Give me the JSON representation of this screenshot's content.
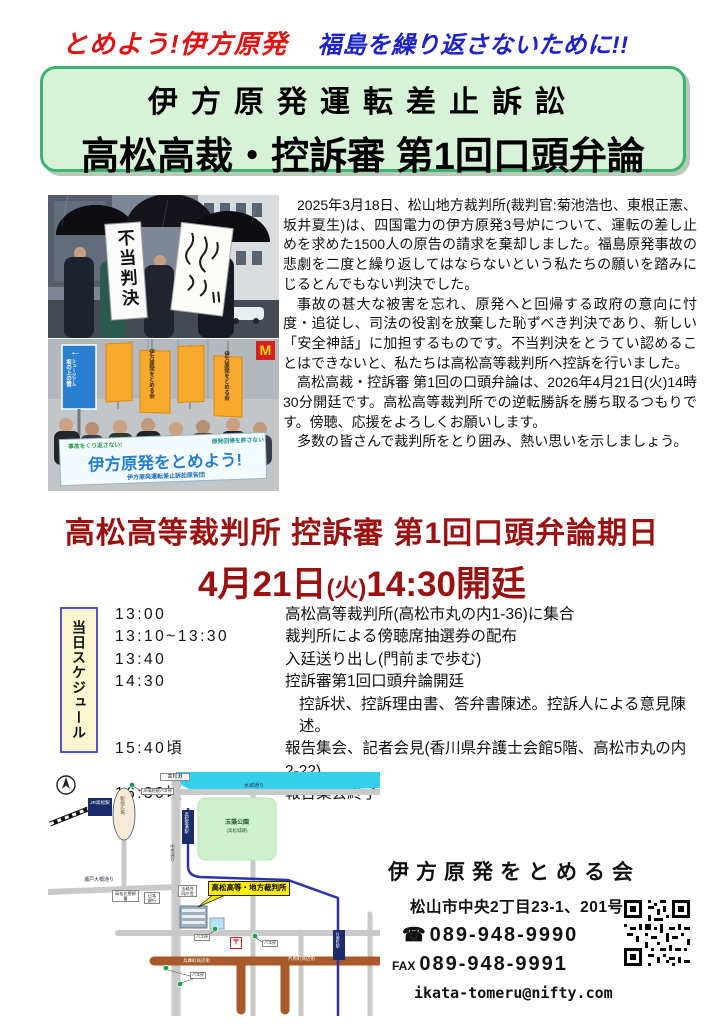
{
  "tagline": {
    "left": "とめよう!伊方原発",
    "right": "福島を繰り返さないために!!"
  },
  "title": {
    "line1": "伊方原発運転差止訴訟",
    "line2": "高松高裁・控訴審 第1回口頭弁論"
  },
  "photos": {
    "top_banner": "不当判決",
    "sign_arrow": "←",
    "sign_line1": "坂の上の雲",
    "sign_line2": "ミュージアム",
    "flag_text": "伊方原発をとめる会",
    "m_sign": "M",
    "banner_small_left": "事故をくり返さない!",
    "banner_small_right": "原発回帰を許さない",
    "banner_main": "伊方原発をとめよう!",
    "banner_sub": "伊方原発運転差止訴訟原告団"
  },
  "body": {
    "p1": "2025年3月18日、松山地方裁判所(裁判官:菊池浩也、東根正憲、坂井夏生)は、四国電力の伊方原発3号炉について、運転の差し止めを求めた1500人の原告の請求を棄却しました。福島原発事故の悲劇を二度と繰り返してはならないという私たちの願いを踏みにじるとんでもない判決でした。",
    "p2": "事故の甚大な被害を忘れ、原発へと回帰する政府の意向に忖度・追従し、司法の役割を放棄した恥ずべき判決であり、新しい「安全神話」に加担するものです。不当判決をとうてい認めることはできないと、私たちは高松高等裁判所へ控訴を行いました。",
    "p3": "高松高裁・控訴審 第1回の口頭弁論は、2026年4月21日(火)14時30分開廷です。高松高等裁判所での逆転勝訴を勝ち取るつもりです。傍聴、応援をよろしくお願いします。",
    "p4": "多数の皆さんで裁判所をとり囲み、熱い思いを示しましょう。"
  },
  "heading": {
    "line1": "高松高等裁判所 控訴審 第1回口頭弁論期日",
    "date": "4月21日",
    "day": "(火)",
    "time": "14:30開廷"
  },
  "schedule": {
    "label": "当日スケジュール",
    "rows": [
      {
        "time": "13:00",
        "desc": "高松高等裁判所(高松市丸の内1-36)に集合"
      },
      {
        "time": "13:10~13:30",
        "desc": "裁判所による傍聴席抽選券の配布"
      },
      {
        "time": "13:40",
        "desc": "入廷送り出し(門前まで歩む)"
      },
      {
        "time": "14:30",
        "desc": "控訴審第1回口頭弁論開廷"
      },
      {
        "time": "",
        "desc": "控訴状、控訴理由書、答弁書陳述。控訴人による意見陳述。"
      },
      {
        "time": "15:40頃",
        "desc": "報告集会、記者会見(香川県弁護士会館5階、高松市丸の内2-22)"
      },
      {
        "time": "16:30頃",
        "desc": "報告集会終了"
      }
    ]
  },
  "map": {
    "minato": "高松港",
    "mizuki_dori": "水城通り",
    "park1": "玉藻公園",
    "park2": "(高松城跡)",
    "chikko_station": "高松築港駅",
    "chuo_dori": "中央通り",
    "jr_station": "JR高松駅",
    "ekimae": "駅前広場",
    "jr_bus_stop": "JR高松駅バス停",
    "seto_dori": "瀬戸大橋通り",
    "police": "高松北警察署",
    "bank": "日本銀行",
    "legal": "法務合同庁舎",
    "courthouse": "高松高等・地方裁判所",
    "post_mark": "〒",
    "hyogo_st": "兵庫町商店街",
    "katahara_st": "片原町商店街",
    "katahara_station": "片原町駅",
    "bus_stop": "バス停"
  },
  "contact": {
    "org": "伊方原発をとめる会",
    "address": "松山市中央2丁目23-1、201号",
    "tel_icon": "☎",
    "tel": "089-948-9990",
    "fax_label": "FAX",
    "fax": "089-948-9991",
    "email": "ikata-tomeru@nifty.com"
  },
  "colors": {
    "tagline_red": "#e31111",
    "tagline_blue": "#1d23c8",
    "title_box_bg": "#d8f2d8",
    "title_box_border": "#3cb371",
    "heading_red": "#9b1111",
    "schedule_box_bg": "#fbf6cf",
    "schedule_box_border": "#5157c8",
    "map_water": "#35d0ee",
    "map_park": "#cdf1cd",
    "callout_yellow": "#ffee00"
  }
}
